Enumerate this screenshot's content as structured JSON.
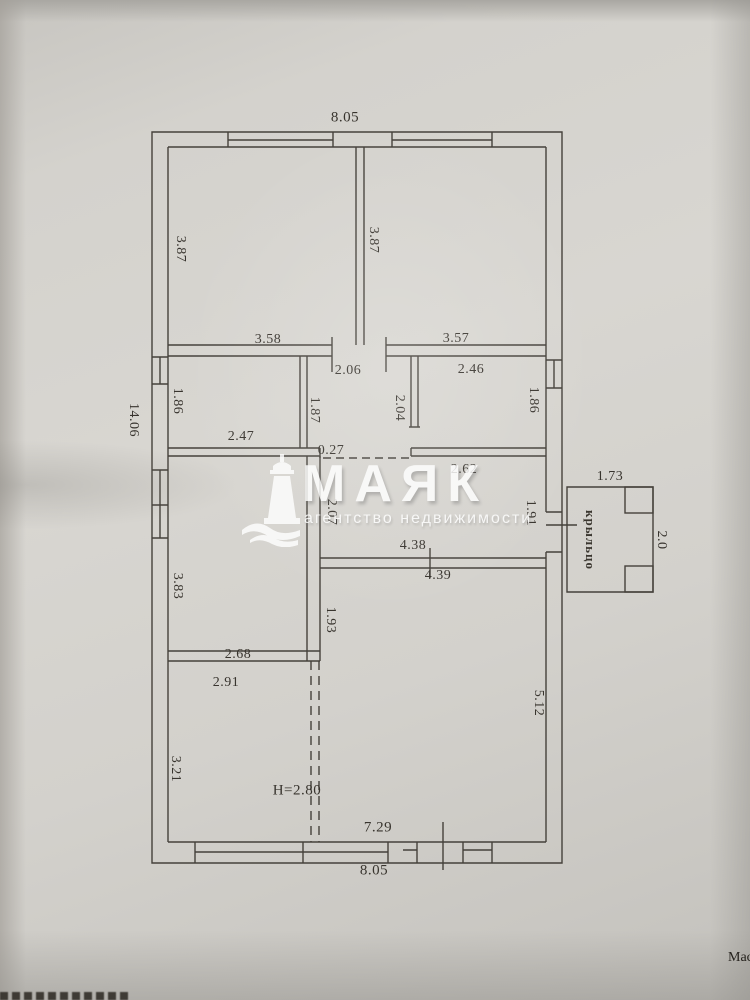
{
  "watermark": {
    "brand": "МАЯК",
    "subtitle": "агентство недвижимости",
    "icon": "lighthouse-icon",
    "color": "#ffffff"
  },
  "plan": {
    "overall": {
      "top_width": "8.05",
      "left_height": "14.06",
      "bottom_width": "8.05",
      "bottom_inner_width": "7.29",
      "ceiling_height": "H=2.80"
    },
    "dims": {
      "room_tl_width": "3.58",
      "room_tl_height": "3.87",
      "room_tr_width": "3.57",
      "room_tr_height": "3.87",
      "room_ml_width": "2.47",
      "room_ml_height": "1.86",
      "corridor_width": "2.06",
      "corridor_height": "1.87",
      "corridor_right_height": "2.04",
      "room_mr_width": "2.46",
      "room_mr_height": "1.86",
      "wall_stub": "0.27",
      "hall_top_width": "2.62",
      "hall_left_height": "2.07",
      "hall_right_height": "1.91",
      "hall_bottom_width": "4.38",
      "living_top_width": "4.39",
      "room_l3_height": "3.83",
      "room_l3_width": "2.68",
      "room_l4_width": "2.91",
      "room_l4_height": "3.21",
      "partition_height": "1.93",
      "living_height": "5.12"
    },
    "porch": {
      "name": "крыльцо",
      "width": "1.73",
      "depth": "2.0"
    },
    "line_color": "#45413b"
  },
  "page": {
    "scale_fragment": "Масш"
  }
}
